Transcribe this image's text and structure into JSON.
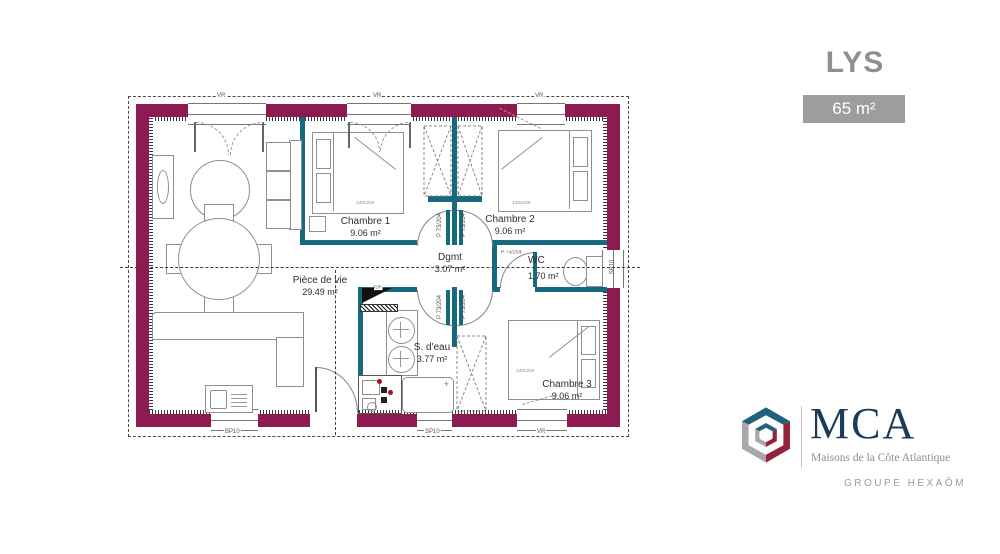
{
  "header": {
    "title": "LYS",
    "area_badge": "65 m²"
  },
  "plan": {
    "rooms": [
      {
        "name": "Chambre 1",
        "area": "9.06 m²"
      },
      {
        "name": "Chambre 2",
        "area": "9.06 m²"
      },
      {
        "name": "Dgmt",
        "area": "3.07 m²"
      },
      {
        "name": "WC",
        "area": "1.70 m²"
      },
      {
        "name": "Pièce de vie",
        "area": "29.49 m²"
      },
      {
        "name": "S. d'eau",
        "area": "3.77 m²"
      },
      {
        "name": "Chambre 3",
        "area": "9.06 m²"
      }
    ],
    "labels": {
      "bed_size": "140x200",
      "door": "P 73/204",
      "tech": "IDF"
    },
    "openings": {
      "vr": "VR",
      "bottom_left": "BP10",
      "bottom_mid": "SP10",
      "bottom_right": "VR",
      "right": "SP10"
    },
    "colors": {
      "wall": "#8e1a52",
      "partition": "#16697e"
    }
  },
  "logo": {
    "name": "MCA",
    "subtitle": "Maisons de la Côte Atlantique",
    "group": "GROUPE HEXAÔM",
    "colors": {
      "navy": "#1c3a5a",
      "red": "#93223f",
      "teal": "#22617c",
      "gray": "#a9a9a9"
    }
  }
}
